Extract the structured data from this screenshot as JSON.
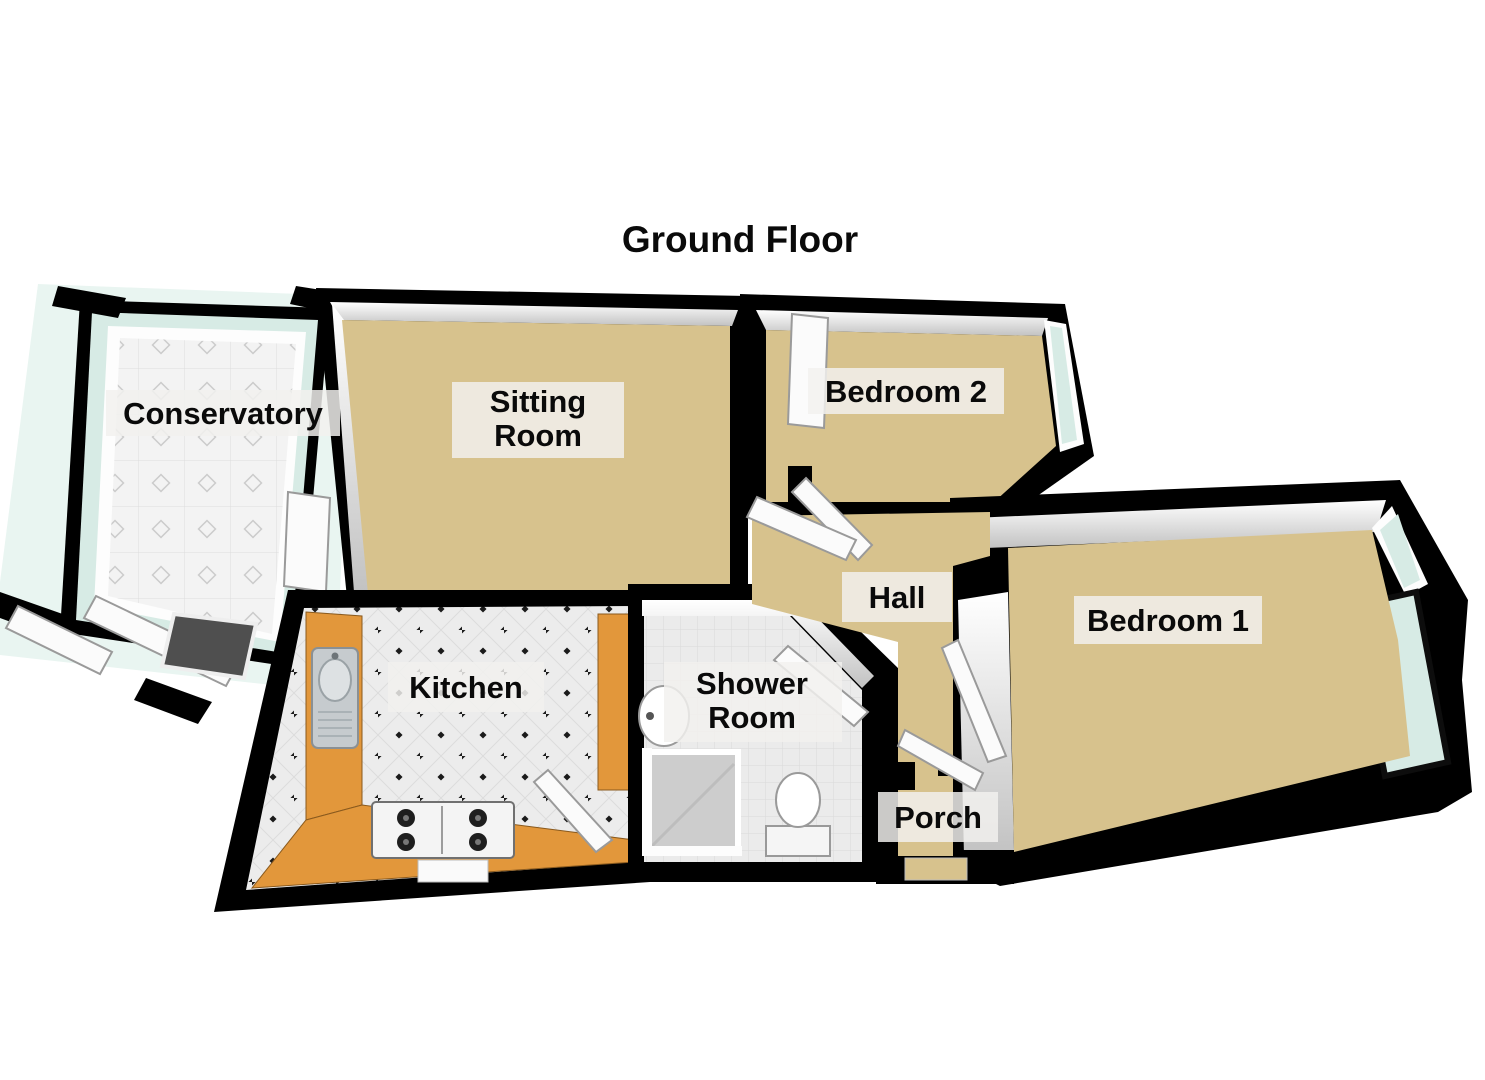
{
  "title": "Ground Floor",
  "rooms": {
    "conservatory": {
      "label": "Conservatory"
    },
    "sitting_room": {
      "line1": "Sitting",
      "line2": "Room"
    },
    "bedroom_2": {
      "label": "Bedroom 2"
    },
    "hall": {
      "label": "Hall"
    },
    "bedroom_1": {
      "label": "Bedroom 1"
    },
    "kitchen": {
      "label": "Kitchen"
    },
    "shower_room": {
      "line1": "Shower",
      "line2": "Room"
    },
    "porch": {
      "label": "Porch"
    }
  },
  "fixtures": {
    "kitchen_sink": "kitchen-sink",
    "gas_hob": "gas-hob",
    "worktop": "kitchen-worktop",
    "shower": "shower-enclosure",
    "toilet": "toilet",
    "basin": "hand-basin",
    "door_mat": "door-mat",
    "doors": "open-door-leaf",
    "windows": "window-glazing"
  },
  "colors": {
    "background": "#ffffff",
    "wall": "#000000",
    "wall_face": "#ffffff",
    "wall_face_shade": "#c9c9c9",
    "carpet": "#d7c28d",
    "tile": "#ededed",
    "tile_line": "#d6d6d6",
    "glass": "#d7ebe5",
    "glass_glow": "#e9f5f1",
    "counter": "#e2973b",
    "wood": "#c08944",
    "steel": "#c6cbce",
    "shower_tray": "#cdcdcd",
    "mat": "#4f4f4f",
    "label_bg": "#f2f1ee",
    "label_text": "#0a0a0a"
  }
}
